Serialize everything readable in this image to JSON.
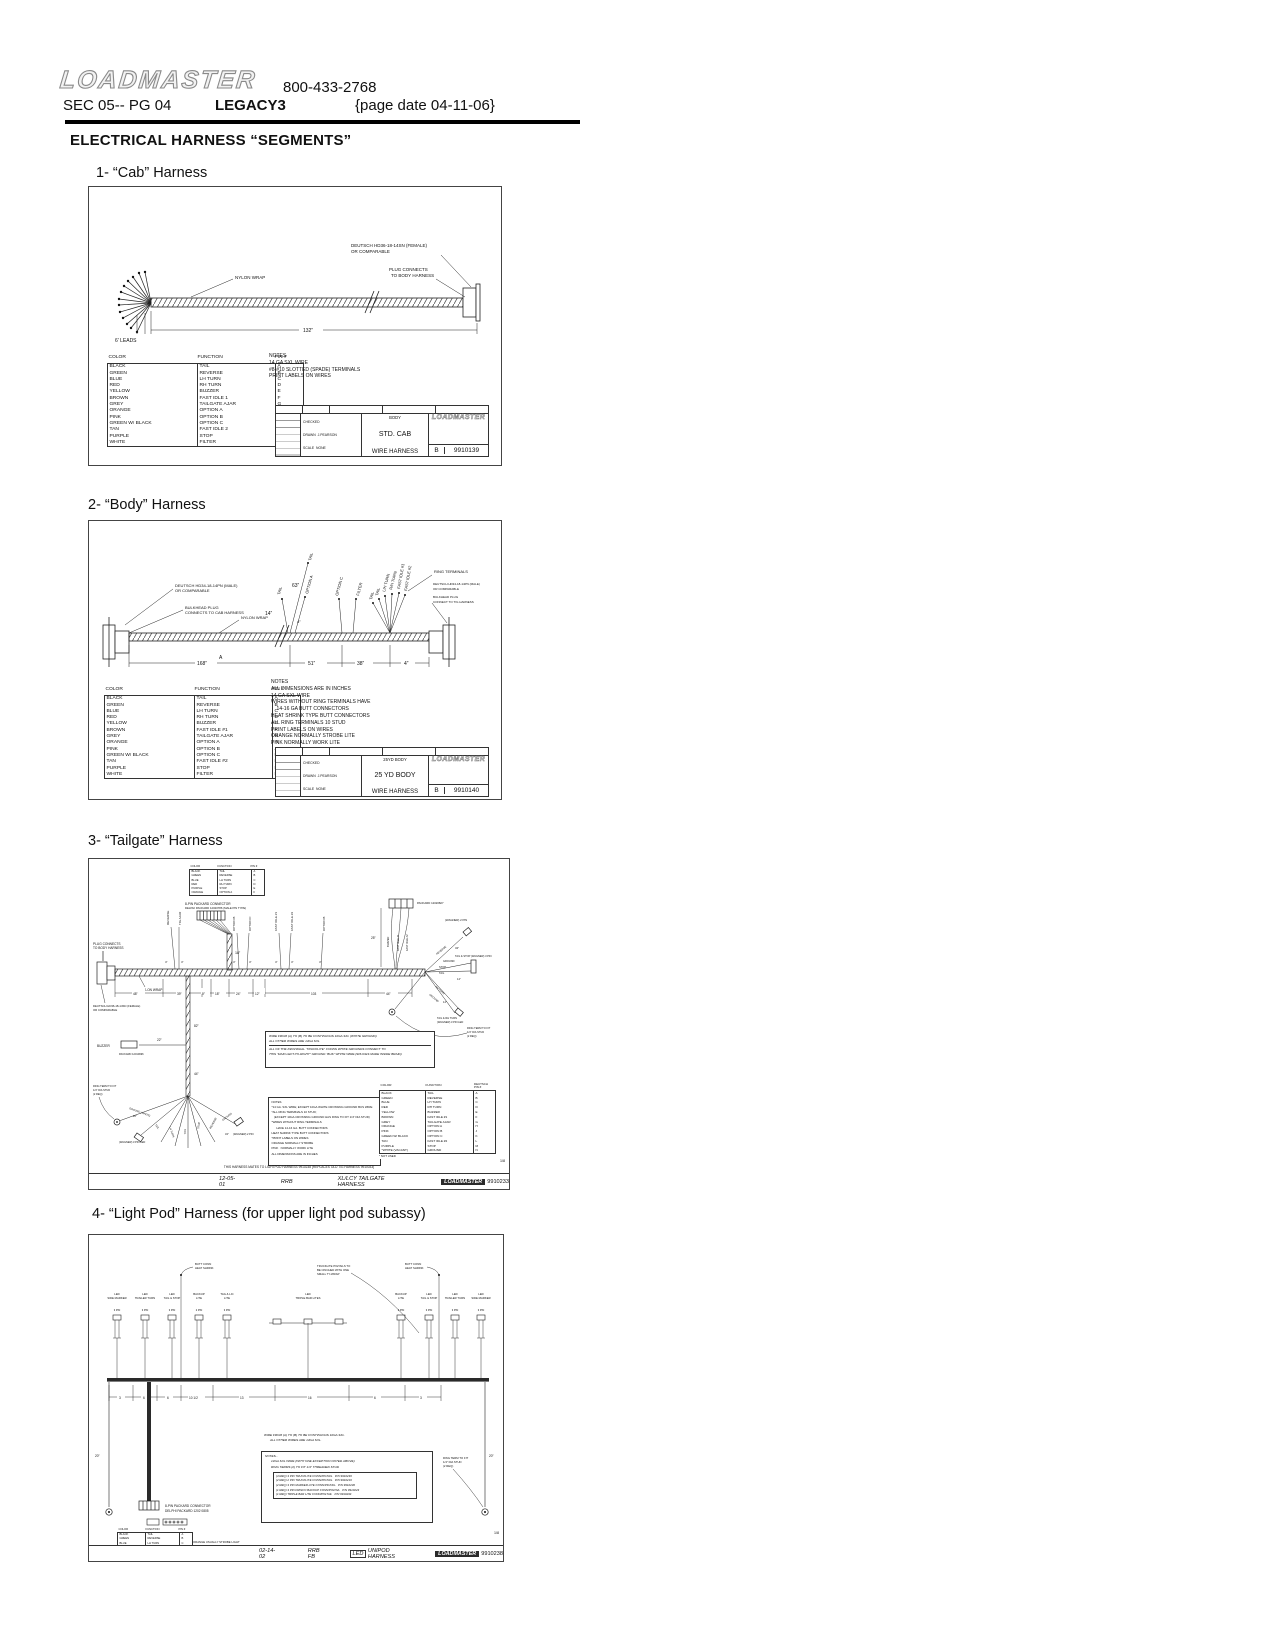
{
  "header": {
    "logo": "LOADMASTER",
    "phone": "800-433-2768",
    "sec": "SEC 05-- PG 04",
    "model": "LEGACY3",
    "page_date": "{page date 04-11-06}",
    "title": "ELECTRICAL HARNESS “SEGMENTS”"
  },
  "th": {
    "color": "COLOR",
    "function": "FUNCTION",
    "pin": "PIN #"
  },
  "th2": {
    "color": "COLOR",
    "function": "FUNCTION",
    "d1": "DEUTSCH",
    "d2": "PIN #"
  },
  "cab": {
    "heading": "1- “Cab” Harness",
    "labels": {
      "deutsch1": "DEUTSCH HD36-18-14SN (FEMALE)",
      "deutsch2": "OR COMPARABLE",
      "plug1": "PLUG CONNECTS",
      "plug2": "TO BODY HARNESS",
      "nylon": "NYLON WRAP",
      "leads": "6' LEADS",
      "dim": "132”"
    },
    "rows": [
      {
        "c": "BLACK",
        "f": "TAIL",
        "p": "A"
      },
      {
        "c": "GREEN",
        "f": "REVERSE",
        "p": "B"
      },
      {
        "c": "BLUE",
        "f": "LH TURN",
        "p": "C"
      },
      {
        "c": "RED",
        "f": "RH TURN",
        "p": "D"
      },
      {
        "c": "YELLOW",
        "f": "BUZZER",
        "p": "E"
      },
      {
        "c": "BROWN",
        "f": "FAST IDLE 1",
        "p": "F"
      },
      {
        "c": "GREY",
        "f": "TAILGATE AJAR",
        "p": "G"
      },
      {
        "c": "ORANGE",
        "f": "OPTION A",
        "p": "H"
      },
      {
        "c": "PINK",
        "f": "OPTION B",
        "p": "J"
      },
      {
        "c": "GREEN W/ BLACK",
        "f": "OPTION C",
        "p": "K"
      },
      {
        "c": "TAN",
        "f": "FAST IDLE 2",
        "p": "L"
      },
      {
        "c": "PURPLE",
        "f": "STOP",
        "p": "M"
      },
      {
        "c": "WHITE",
        "f": "FILTER",
        "p": "N"
      }
    ],
    "notes": {
      "title": "NOTES",
      "items": [
        "14 GA SXL WIRE",
        "#8-#10 SLOTTED (SPADE) TERMINALS",
        "PRINT LABELS ON WIRES"
      ]
    },
    "tb": {
      "checked": "CHECKED",
      "drawn": "DRAWN",
      "drawn_by": "J.PEARSON",
      "scale": "SCALE",
      "scale_val": "NONE",
      "next": "BODY",
      "t1": "STD. CAB",
      "t2": "WIRE HARNESS",
      "rev": "B",
      "num": "9910139",
      "brand": "LOADMASTER"
    }
  },
  "body": {
    "heading": "2- “Body” Harness",
    "labels": {
      "l1": "DEUTSCH HD34-18-14PN (MALE)",
      "l2": "OR COMPARABLE",
      "l3": "BULKHEAD PLUG",
      "l4": "CONNECTS TO CAB HARNESS",
      "nylon": "NYLON WRAP",
      "r1": "RING TERMINALS",
      "r2": "DEUTSCH HD34-18-14PN (MALE)",
      "r3": "OR COMPARABLE",
      "r4": "BULKHEAD PLUG",
      "r5": "CONNECT TO T/G HARNESS"
    },
    "branches": [
      "TAIL",
      "TAIL",
      "OPTION A",
      "OPTION C",
      "FILTER",
      "TAIL",
      "TAIL",
      "L/H TURN",
      "R/H TURN",
      "FAST IDLE #1",
      "FAST IDLE #2"
    ],
    "dims": {
      "d63": "63”",
      "d14": "14”",
      "d4": "4”",
      "d168": "168”",
      "a": "A",
      "d51": "51”",
      "d38": "38”"
    },
    "rows": [
      {
        "c": "BLACK",
        "f": "TAIL",
        "p": "A"
      },
      {
        "c": "GREEN",
        "f": "REVERSE",
        "p": "B"
      },
      {
        "c": "BLUE",
        "f": "LH TURN",
        "p": "C"
      },
      {
        "c": "RED",
        "f": "RH TURN",
        "p": "D"
      },
      {
        "c": "YELLOW",
        "f": "BUZZER",
        "p": "E"
      },
      {
        "c": "BROWN",
        "f": "FAST IDLE #1",
        "p": "F"
      },
      {
        "c": "GREY",
        "f": "TAILGATE AJAR",
        "p": "G"
      },
      {
        "c": "ORANGE",
        "f": "OPTION A",
        "p": "H"
      },
      {
        "c": "PINK",
        "f": "OPTION B",
        "p": "J"
      },
      {
        "c": "GREEN W/ BLACK",
        "f": "OPTION C",
        "p": "K"
      },
      {
        "c": "TAN",
        "f": "FAST IDLE #2",
        "p": "L"
      },
      {
        "c": "PURPLE",
        "f": "STOP",
        "p": "M"
      },
      {
        "c": "WHITE",
        "f": "FILTER",
        "p": "N"
      }
    ],
    "notes": {
      "title": "NOTES",
      "items": [
        "ALL DIMENSIONS ARE IN INCHES",
        "14 GA SXL WIRE",
        "WIRES WITHOUT RING TERMINALS HAVE",
        "    14-16 GA BUTT CONNECTORS",
        "HEAT SHRINK TYPE BUTT CONNECTORS",
        "ALL RING TERMINALS 10 STUD",
        "PRINT LABELS ON WIRES",
        "ORANGE NORMALLY STROBE LITE",
        "PINK NORMALLY WORK LITE"
      ]
    },
    "tb": {
      "checked": "CHECKED",
      "drawn": "DRAWN",
      "drawn_by": "J.PEARSON",
      "scale": "SCALE",
      "scale_val": "NONE",
      "next": "25YD BODY",
      "t1": "25 YD BODY",
      "t2": "WIRE HARNESS",
      "rev": "B",
      "num": "9910140",
      "brand": "LOADMASTER"
    }
  },
  "tailgate": {
    "heading": "3- “Tailgate” Harness",
    "mini_rows": [
      {
        "c": "BLACK",
        "f": "TAIL",
        "p": "A"
      },
      {
        "c": "GREEN",
        "f": "REVERSE",
        "p": "B"
      },
      {
        "c": "BLUE",
        "f": "LH TURN",
        "p": "C"
      },
      {
        "c": "RED",
        "f": "RH TURN",
        "p": "D"
      },
      {
        "c": "PURPLE",
        "f": "STOP",
        "p": "E"
      },
      {
        "c": "ORANGE",
        "f": "OPTION A",
        "p": "F"
      }
    ],
    "labels": {
      "packard1": "8-PIN PACKARD CONNECTOR",
      "packard2": "DELPHI PACKARD 12020786 (MALE PIN TYPE)",
      "plug1": "PLUG CONNECTS",
      "plug2": "TO BODY HARNESS",
      "deutsch1": "DEUTSCH HD36-18-14SN (FEMALE)",
      "deutsch2": "OR COMPARABLE",
      "nylon": "NYLON WRAP",
      "buzzer": "BUZZER",
      "buzzer_conn": "PACKARD 12010996",
      "packard_r": "PACKARD 12020827",
      "ring1": "RING TERM TO FIT",
      "ring2": "1/4” DIA STUD",
      "ring3": "(2 REQ)",
      "trucklite1": "TRUCKLITE PIGTAILS TO",
      "trucklite2": "BE CINCHED WITH ONE",
      "trucklite3": "SMALL TY-WRAP",
      "tag_2pin": "(WAGNER) 2 PIN",
      "tag_3pin": "TAIL & STOP (WAGNER) 3 PIN",
      "tag_3pinled": "(WAGNER) 3 PIN LED",
      "tag_rh": "TAIL & RH TURN"
    },
    "branches": [
      "REVERSE",
      "T/G AJAR",
      "OPTION B",
      "OPTION C",
      "FAST IDLE #1",
      "FAST IDLE #2",
      "OPTION B"
    ],
    "rbr": [
      "BUZZER",
      "FAST IDLE #1",
      "FAST IDLE #2"
    ],
    "fan": [
      "REVERSE",
      "GROUND",
      "STOP",
      "TAIL",
      "RH TURN",
      "GROUND"
    ],
    "fan2": [
      "GROUND (WHITE)",
      "TAIL",
      "LH TURN",
      "TAIL",
      "STOP",
      "REVERSE",
      "GROUND"
    ],
    "dims": {
      "d4": "4”",
      "d18": "18”",
      "d25": "25”",
      "d48": "48”",
      "d39": "39”",
      "d9": "9”",
      "d24": "24”",
      "d12": "12”",
      "d103": "103",
      "d44": "44”",
      "d82": "82”",
      "d22": "22”",
      "d34": "34”",
      "d14": "14”",
      "d20": "20”"
    },
    "gnote": {
      "l1": "WIRE FROM (A) TO (B) TO BE CONTINUOUS 10GA SXL (WHITE GROUND)",
      "l2": "ALL OTHER WIRES ARE 14GA SXL",
      "l3": "ALL OF THE INDIVIDUAL “TRUCKLITE” CONNS WHITE GROUNDS CONNECT TO",
      "l4": "THIS “MAIN LEFT-TO-RIGHT” GROUND “BUS” WHITE WIRE.(SPLICES MADE INSIDE BRAID)"
    },
    "notes": {
      "items": [
        "NOTES",
        "*14 GA. SXL WIRE; EXCEPT 10GA WHITE CROSSING GROUND BUS WIRE",
        "*ALL RING TERMINALS 10 STUD;",
        "   (EXCEPT 10GA CROSSING GROUND HAS RING TO FIT 1/4” DIA STUD)",
        "*WIRES WITHOUT RING TERMINALS",
        "      HAVE 14-16 GA. BUTT CONNECTORS",
        "HEAT SHRINK TYPE BUTT CONNECTORS",
        "*PRINT LABELS ON WIRES",
        "ORANGE NORMALLY STROBE",
        "PINK   NORMALLY WORK LITE",
        "ALL DIMENSIONS ARE IN INCHES"
      ]
    },
    "rows": [
      {
        "c": "BLACK",
        "f": "TAIL",
        "p": "A"
      },
      {
        "c": "GREEN",
        "f": "REVERSE",
        "p": "B"
      },
      {
        "c": "BLUE",
        "f": "LH TURN",
        "p": "C"
      },
      {
        "c": "RED",
        "f": "RH TURN",
        "p": "D"
      },
      {
        "c": "YELLOW",
        "f": "BUZZER",
        "p": "E"
      },
      {
        "c": "BROWN",
        "f": "FAST IDLE #1",
        "p": "F"
      },
      {
        "c": "GREY",
        "f": "TAILGATE AJAR",
        "p": "G"
      },
      {
        "c": "ORANGE",
        "f": "OPTION A",
        "p": "H"
      },
      {
        "c": "PINK",
        "f": "OPTION B",
        "p": "J"
      },
      {
        "c": "GREEN W/ BLACK",
        "f": "OPTION C",
        "p": "K"
      },
      {
        "c": "TAN",
        "f": "FAST IDLE #2",
        "p": "L"
      },
      {
        "c": "PURPLE",
        "f": "STOP",
        "p": "M"
      },
      {
        "c": "*WHITE (VACANT)",
        "f": "GROUND",
        "p": "N"
      }
    ],
    "not_used": "* NOT USED",
    "mates": "THIS HARNESS MATES TO LIGHTPOD HARNESS 9910238 (REPLACES OLD T/G HARNESS 9910033)",
    "strip": {
      "date": "12-05-01",
      "by": "RRB",
      "title": "XL/LCY TAILGATE HARNESS",
      "brand": "LOADMASTER",
      "num": "9910233",
      "sheet": "1/8"
    }
  },
  "lightpod": {
    "heading": "4- “Light Pod” Harness (for upper light pod subassy)",
    "fixtures": [
      {
        "l1": "LED",
        "l2": "SIDE MARKER",
        "tag": "3 PIN"
      },
      {
        "l1": "LED",
        "l2": "TRAILER TURN",
        "tag": "3 PIN"
      },
      {
        "l1": "LED",
        "l2": "TAIL & STOP",
        "tag": "3 PIN"
      },
      {
        "l1": "BACKUP",
        "l2": "LITE",
        "tag": "2 PIN"
      },
      {
        "l1": "TAG & LIC",
        "l2": "LITE",
        "tag": "3 PIN"
      },
      {
        "l1": "LED",
        "l2": "TRIPLE BAR LITES",
        "tag": ""
      },
      {
        "l1": "BACKUP",
        "l2": "LITE",
        "tag": "2 PIN"
      },
      {
        "l1": "LED",
        "l2": "TAIL & STOP",
        "tag": "3 PIN"
      },
      {
        "l1": "LED",
        "l2": "TRAILER TURN",
        "tag": "3 PIN"
      },
      {
        "l1": "LED",
        "l2": "SIDE MARKER",
        "tag": "3 PIN"
      }
    ],
    "labels": {
      "butt1": "BUTT CONN",
      "butt2": "HEAT SHRINK",
      "trucklite1": "TRUCKLITE PIGTAILS TO",
      "trucklite2": "BE CINCHED WITH ONE",
      "trucklite3": "SMALL TY-WRAP",
      "packard1": "8-PIN PACKARD CONNECTOR",
      "packard2": "DELPHI PACKARD 1202 0805",
      "ring1": "RING TERM TO FIT",
      "ring2": "1/4” DIA STUD",
      "ring3": "(2 REQ)",
      "orange_note": "ORANGE USUALLY STROBE LIGHT"
    },
    "gnote": {
      "l1": "WIRE FROM (A) TO (B) TO BE CONTINUOUS 10GA SXL.",
      "l2": "ALL OTHER WIRES ARE 14GA SXL."
    },
    "notes": {
      "t": "NOTES...",
      "l1": "14GA SXL WIRE (WITH ONE EXCEPTION NOTED ABOVE)",
      "l2": "RING TERMS (2) TO FIT 1/4” THREADED STUD",
      "parts": [
        "(4 REQ) 3 PIN TRUCKLITE CONN/PIGTAIL   P/N 9910239",
        "(2 REQ) 2 PIN TRUCKLITE CONN/PIGTAIL   P/N 9910219",
        "(2 REQ) 3 PIN MARKER LITE CONN/PIGTAIL   P/N 9910230",
        "(1 REQ) 3 PIN FRISCO BACKUP CONN/PIGTAIL   P/N 9910223",
        "(1 REQ) TRIPLE BAR LITE CONN/PIGTAIL   P/N 9910234"
      ]
    },
    "dims": [
      "3",
      "6",
      "6",
      "10 1/2",
      "13",
      "16",
      "6",
      "3"
    ],
    "side": {
      "l": "20”",
      "r": "20”"
    },
    "mini_rows": [
      {
        "c": "BLACK",
        "f": "TAIL",
        "p": "A"
      },
      {
        "c": "GREEN",
        "f": "REVERSE",
        "p": "B"
      },
      {
        "c": "BLUE",
        "f": "LH TURN",
        "p": "C"
      },
      {
        "c": "RED",
        "f": "RH TURN",
        "p": "D"
      },
      {
        "c": "PURPLE",
        "f": "STOP",
        "p": "E"
      },
      {
        "c": "ORANGE",
        "f": "OPTION A",
        "p": "F"
      }
    ],
    "strip": {
      "date": "02-14-02",
      "by": "RRB FB",
      "tag": "LED",
      "title": "UNIPOD HARNESS",
      "brand": "LOADMASTER",
      "num": "9910238",
      "sheet": "1/8"
    }
  }
}
